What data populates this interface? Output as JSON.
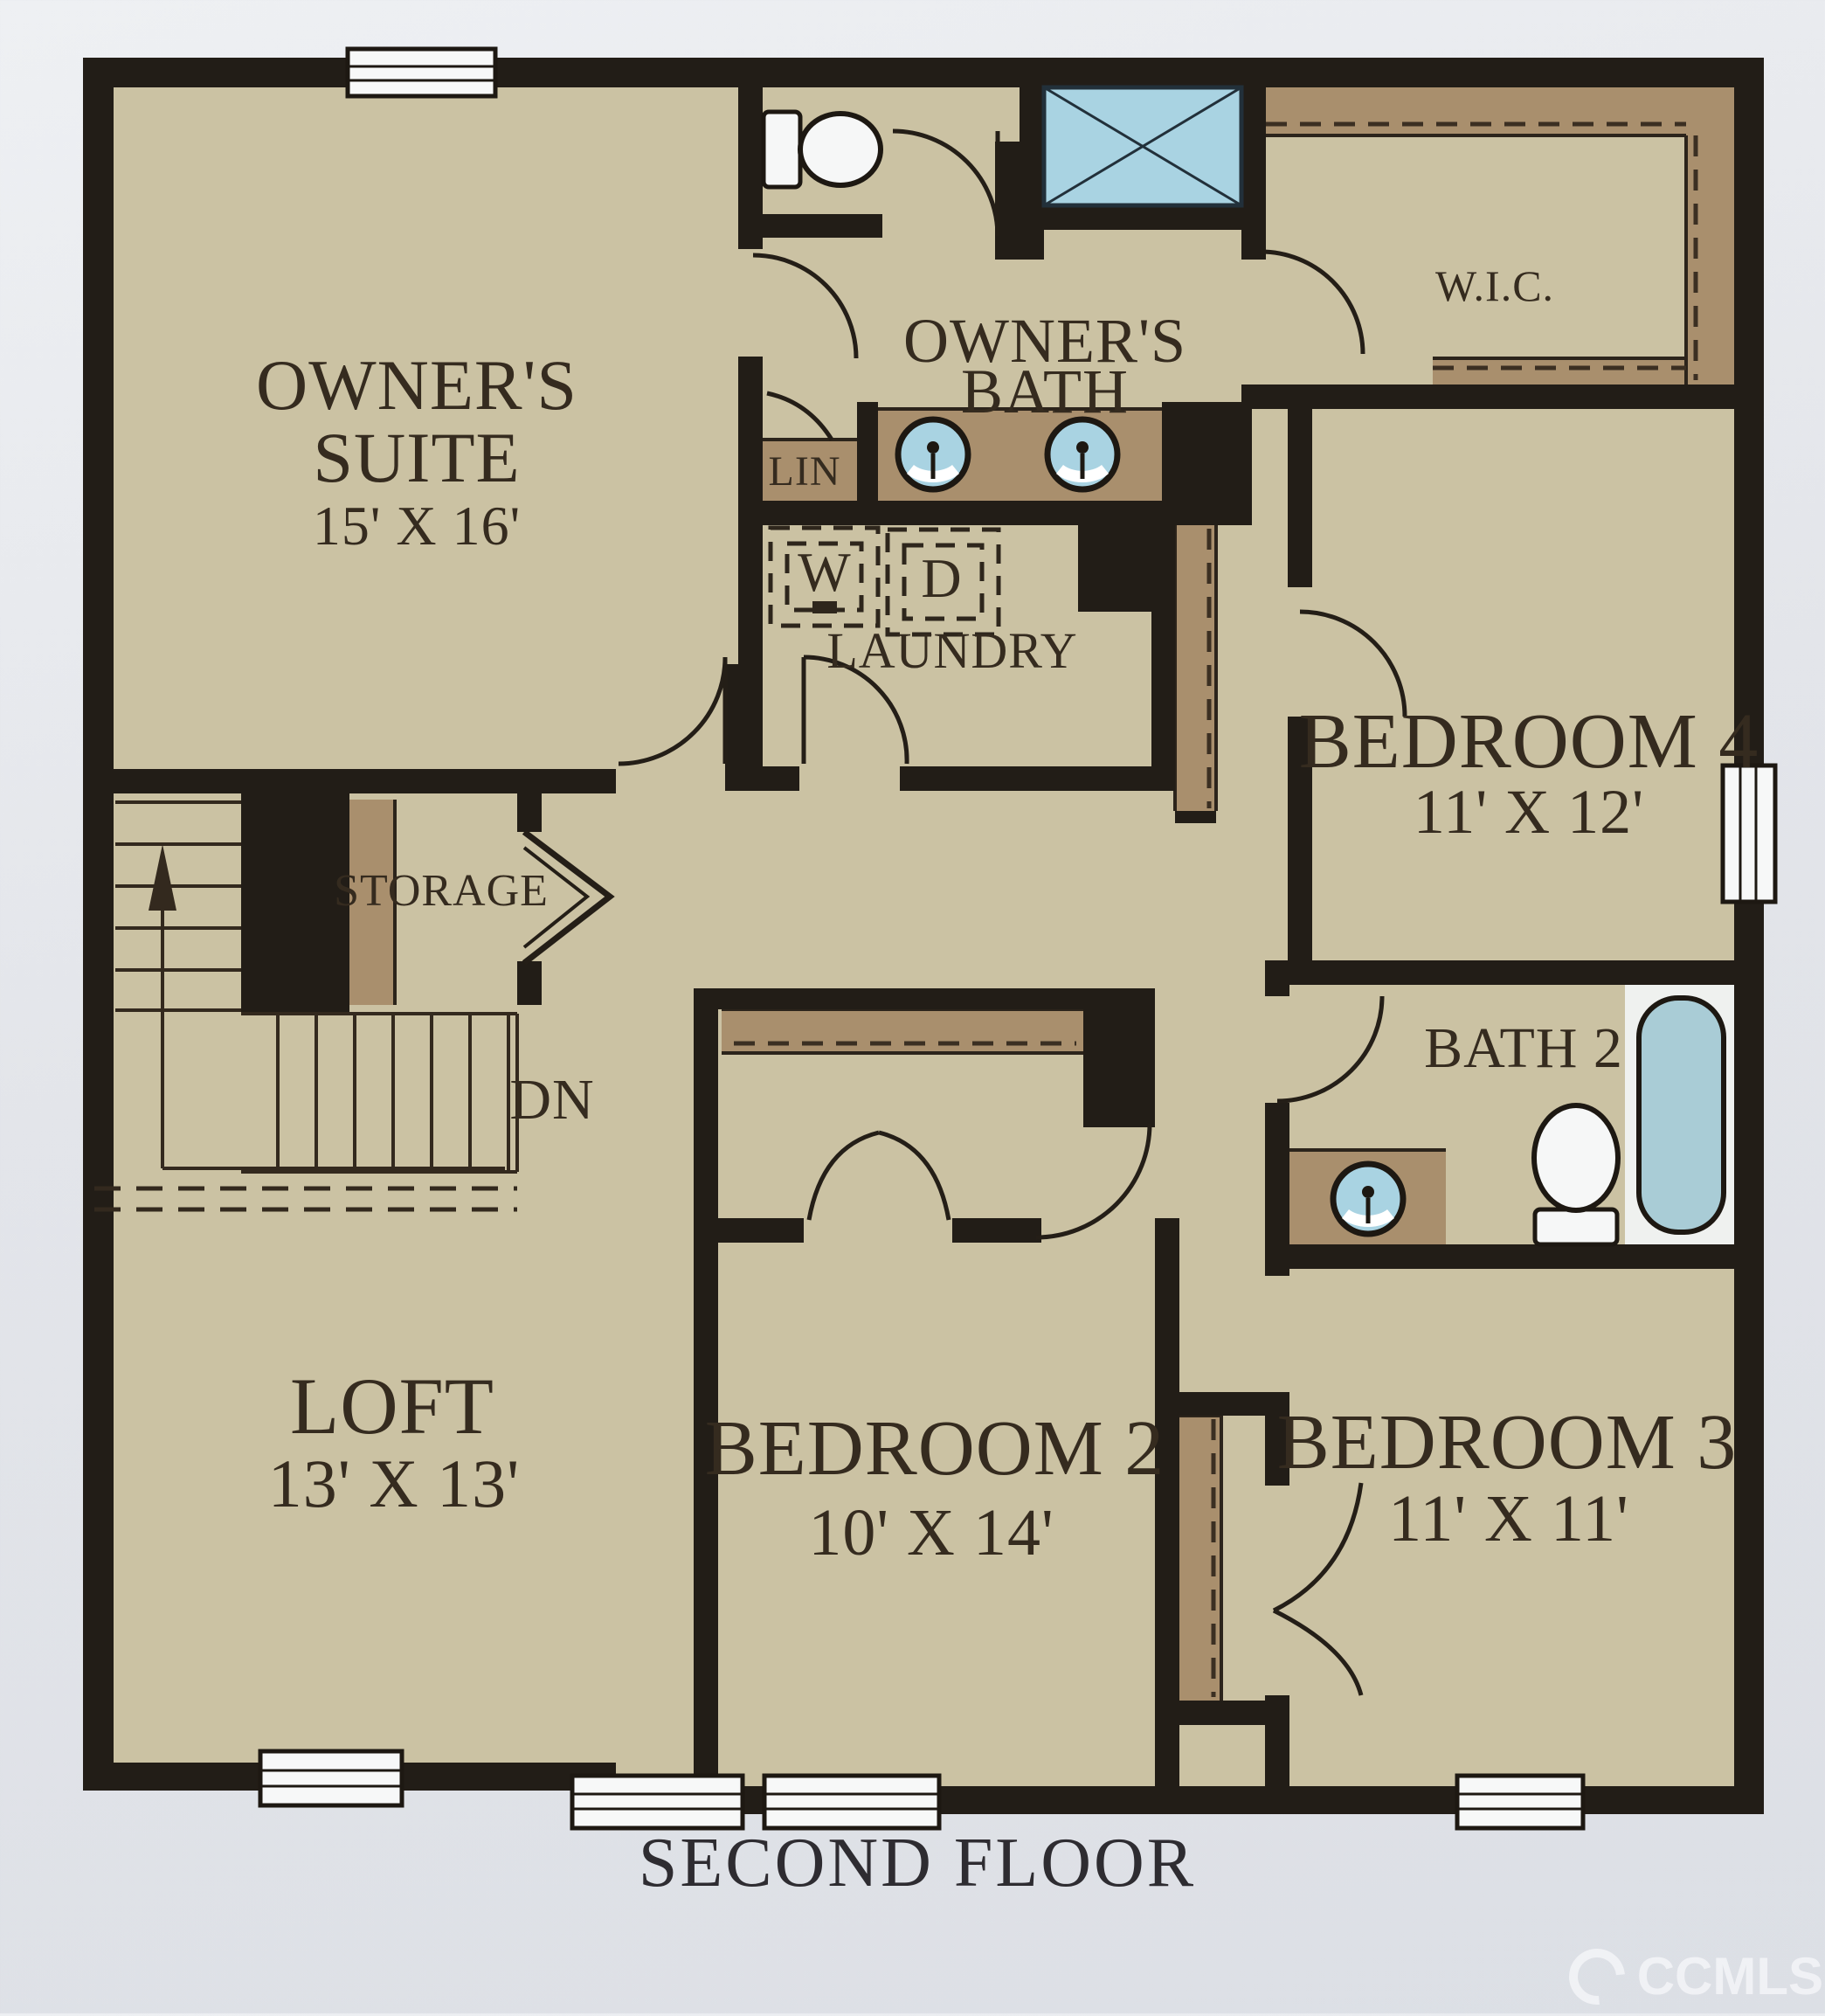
{
  "labels": {
    "owners_suite": {
      "line1": "OWNER'S",
      "line2": "SUITE",
      "dims": "15' X 16'"
    },
    "owners_bath": {
      "line1": "OWNER'S",
      "line2": "BATH"
    },
    "wic": {
      "label": "W.I.C."
    },
    "lin": {
      "label": "LIN"
    },
    "laundry": {
      "label": "LAUNDRY",
      "washer": "W",
      "dryer": "D"
    },
    "bedroom4": {
      "label": "BEDROOM 4",
      "dims": "11' X 12'"
    },
    "storage": {
      "label": "STORAGE"
    },
    "stairs": {
      "down": "DN"
    },
    "bath2": {
      "label": "BATH 2"
    },
    "loft": {
      "label": "LOFT",
      "dims": "13' X 13'"
    },
    "bedroom2": {
      "label": "BEDROOM 2",
      "dims": "10' X 14'"
    },
    "bedroom3": {
      "label": "BEDROOM 3",
      "dims": "11' X 11'"
    }
  },
  "footer": {
    "title": "SECOND FLOOR",
    "watermark": "CCMLS"
  },
  "colors": {
    "paper": "#e4e6ea",
    "floor_tan": "#cbc2a3",
    "wall_black": "#221d17",
    "closet_brown": "#a98f6d",
    "fixture_blue": "#a9d3e2",
    "tub_blue": "#a9ccd6",
    "fixture_white": "#f6f7f7",
    "text": "#352b1f"
  },
  "fixtures": [
    "toilet-icon",
    "toilet-icon",
    "shower-icon",
    "sink-icon",
    "sink-icon",
    "sink-icon",
    "bathtub-icon",
    "washer-box",
    "dryer-box",
    "stairs-up",
    "stairs-down",
    "window",
    "window",
    "window",
    "window",
    "window",
    "window",
    "door-arc"
  ]
}
